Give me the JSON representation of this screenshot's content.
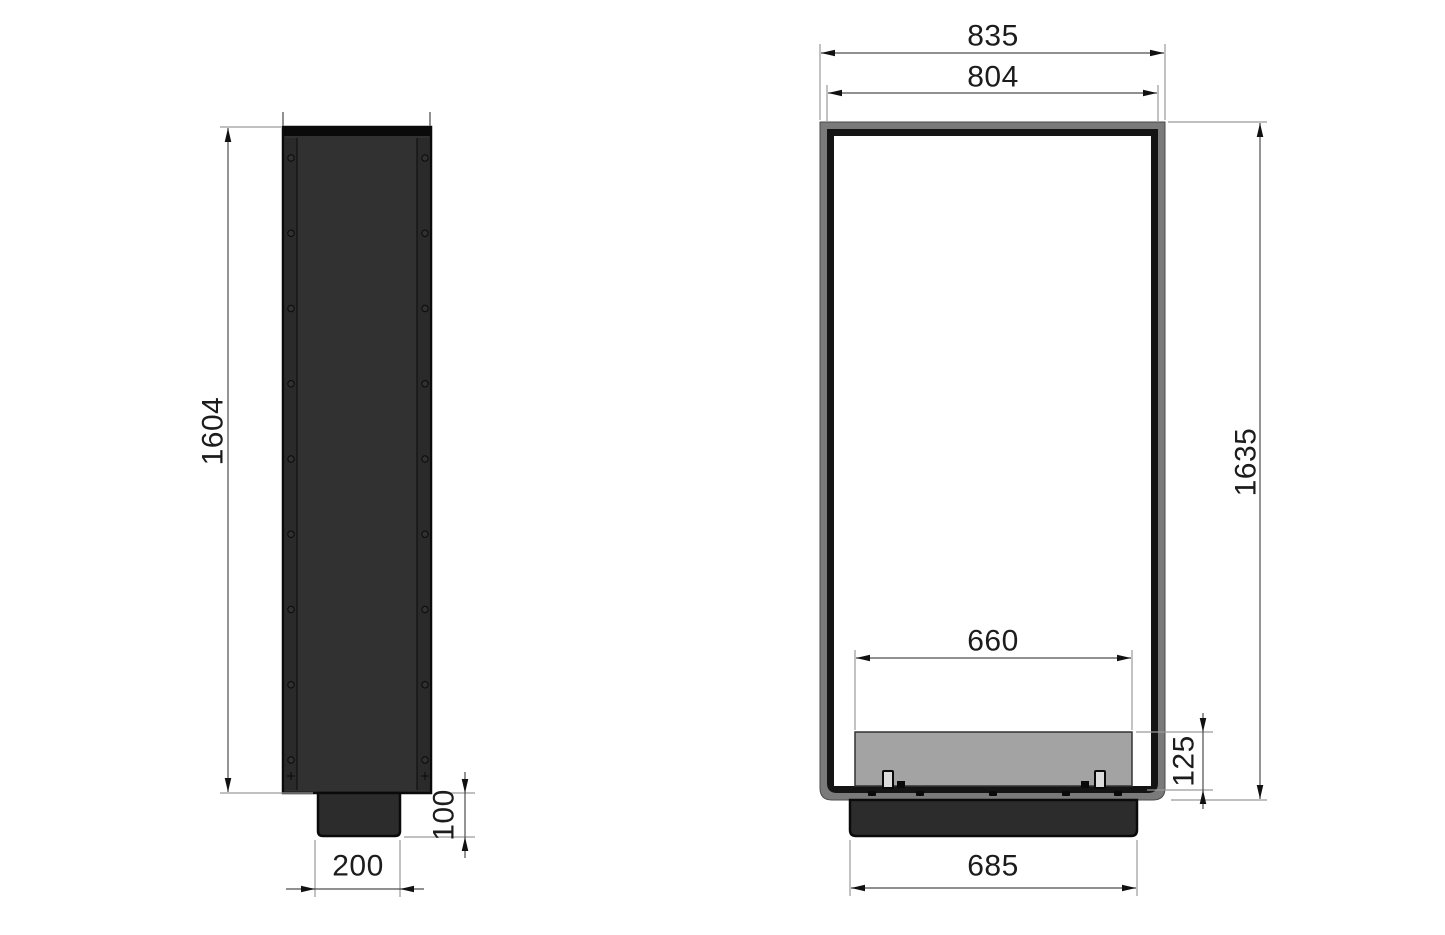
{
  "drawing": {
    "views": {
      "side": {
        "name": "side-view",
        "dimensions": {
          "height": "1604",
          "base_height": "100",
          "base_width": "200"
        }
      },
      "front": {
        "name": "front-view",
        "dimensions": {
          "outer_width": "835",
          "opening_width": "804",
          "height": "1635",
          "burner_width": "660",
          "burner_height": "125",
          "base_width": "685"
        }
      }
    },
    "details": {
      "side_screw_rows": 9,
      "floor_screw_count": 5
    },
    "colors": {
      "bg": "#ffffff",
      "steel_dark": "#313131",
      "steel_flange": "#2a2a2a",
      "steel_base": "#2c2c2c",
      "steel_edge": "#0a0a0a",
      "frame_gray": "#7a7a7a",
      "frame_gray_edge": "#4a4a4a",
      "frame_black": "#141414",
      "opening_white": "#ffffff",
      "burner_gray": "#a3a3a3",
      "burner_edge": "#333333",
      "clip_light": "#dcdcdc",
      "ext_line": "#9a9a9a",
      "tick_line": "#6b6b6b",
      "dim_line": "#4d4d4d",
      "arrow": "#111111",
      "text": "#1c1c1c"
    }
  }
}
